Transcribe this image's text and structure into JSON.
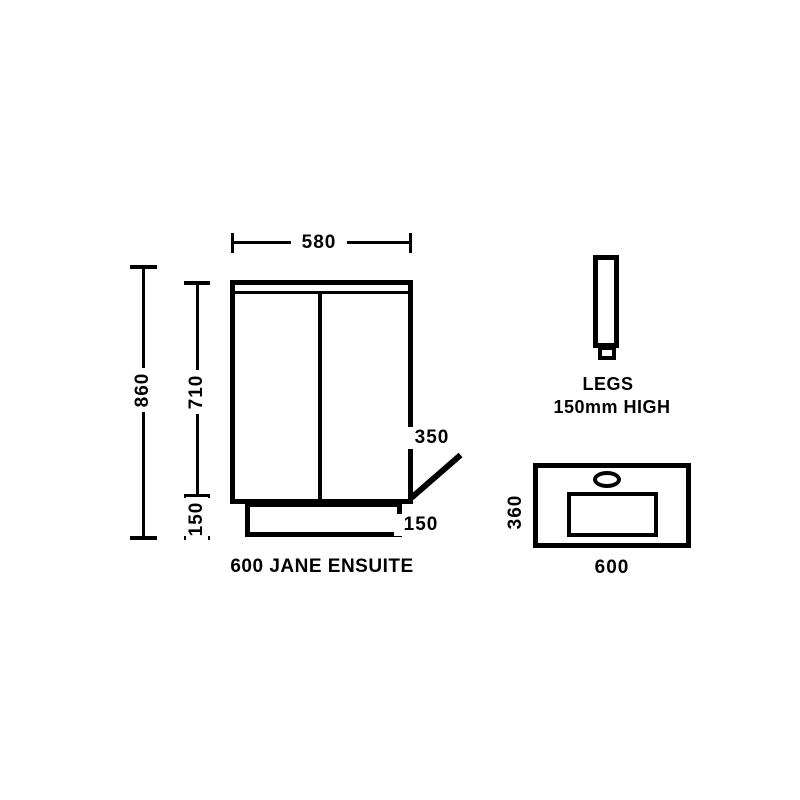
{
  "front_view": {
    "title": "600 JANE ENSUITE",
    "top_width_dim": "580",
    "overall_height_dim": "860",
    "carcass_height_dim": "710",
    "plinth_height_dim_left": "150",
    "depth_dim": "350",
    "plinth_dim_right": "150"
  },
  "legs_detail": {
    "label_line1": "LEGS",
    "label_line2": "150mm HIGH"
  },
  "basin_top_view": {
    "depth_dim": "360",
    "width_dim": "600"
  },
  "colors": {
    "line": "#000000",
    "background": "#ffffff"
  }
}
